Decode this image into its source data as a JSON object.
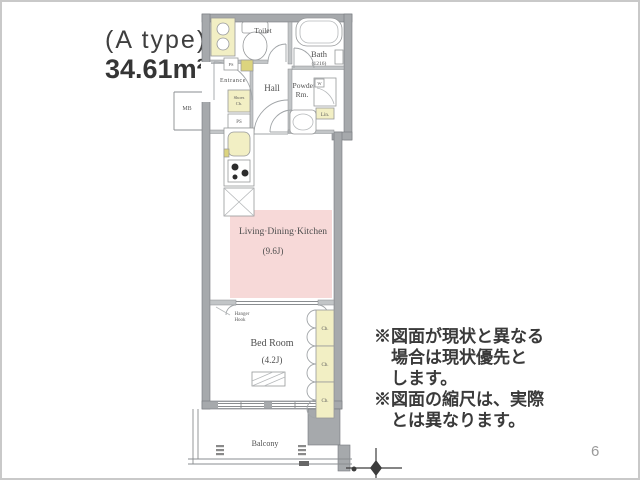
{
  "plan_header": {
    "type_label": "(A type)",
    "area_label": "34.61m²"
  },
  "rooms": {
    "toilet": {
      "label": "Toilet"
    },
    "bath": {
      "label": "Bath",
      "size": "(1216)"
    },
    "entrance": {
      "label": "Entrance"
    },
    "hall": {
      "label": "Hall"
    },
    "powder": {
      "line1": "Powder",
      "line2": "Rm."
    },
    "ldk": {
      "label": "Living·Dining·Kitchen",
      "size": "(9.6J)"
    },
    "bedroom": {
      "label": "Bed Room",
      "size": "(4.2J)"
    },
    "balcony": {
      "label": "Balcony"
    }
  },
  "fixtures": {
    "shoes_cabinet": {
      "line1": "Shoes",
      "line2": "Cb."
    },
    "pipe_space": "PS",
    "meter_box": "MB",
    "washer": "W",
    "linen": "Lin.",
    "closet": "Cb.",
    "hanger_hook": {
      "line1": "Hanger",
      "line2": "Hook"
    }
  },
  "notes": {
    "lines": [
      "※図面が現状と異なる",
      "場合は現状優先と",
      "します。",
      "※図面の縮尺は、実際",
      "とは異なります。"
    ]
  },
  "page": {
    "number": "6"
  },
  "symbols": {
    "compass": "compass-cross-icon",
    "laundry_marks": "laundry-hook-mark",
    "stove": "stove-burners-icon",
    "sink": "kitchen-sink-icon",
    "refrigerator_space": "crossed-box-refrigerator-icon"
  },
  "colors": {
    "wall_gray": "#a6a9ac",
    "partition_gray": "#c2c5c7",
    "fixture_yellow": "#f2efc4",
    "dark_yellow": "#dcd47e",
    "ldk_pink": "#f7d9d8",
    "label_gray": "#4f4f4f",
    "border_gray": "#c9c9c9"
  }
}
